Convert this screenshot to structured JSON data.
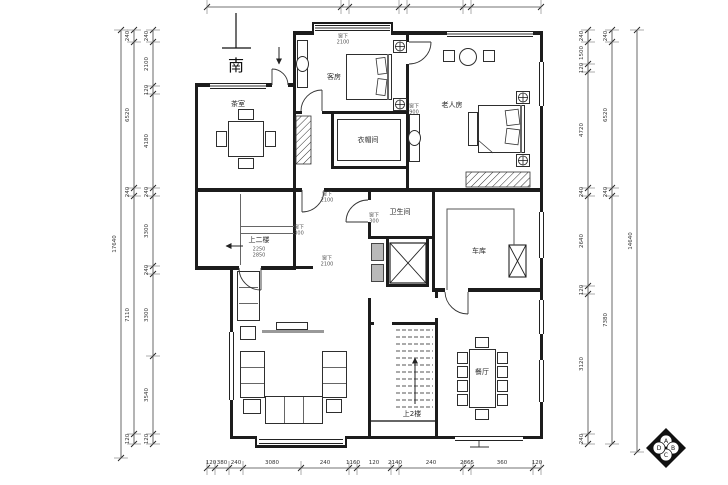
{
  "compass": {
    "label": "南"
  },
  "rooms": [
    {
      "id": "tea-room",
      "label": "茶室",
      "x": 238,
      "y": 104
    },
    {
      "id": "guest-room",
      "label": "客房",
      "x": 334,
      "y": 77
    },
    {
      "id": "elder-room",
      "label": "老人房",
      "x": 452,
      "y": 105
    },
    {
      "id": "cloak-room",
      "label": "衣帽间",
      "x": 368,
      "y": 140
    },
    {
      "id": "bath-room",
      "label": "卫生间",
      "x": 400,
      "y": 212
    },
    {
      "id": "garage",
      "label": "车库",
      "x": 479,
      "y": 251
    },
    {
      "id": "dining-room",
      "label": "餐厅",
      "x": 482,
      "y": 372
    },
    {
      "id": "stair-up",
      "label": "上2楼",
      "x": 412,
      "y": 414
    },
    {
      "id": "hall-up",
      "label": "上二楼",
      "x": 259,
      "y": 240
    }
  ],
  "annotations": [
    {
      "id": "win-top-guest",
      "line1": "窗下",
      "line2": "2100",
      "x": 343,
      "y": 40
    },
    {
      "id": "win-corr-1",
      "line1": "窗下",
      "line2": "2100",
      "x": 327,
      "y": 198
    },
    {
      "id": "win-corr-2",
      "line1": "窗下",
      "line2": "2100",
      "x": 327,
      "y": 262
    },
    {
      "id": "win-hall",
      "line1": "窗下",
      "line2": "300",
      "x": 299,
      "y": 231
    },
    {
      "id": "win-duct",
      "line1": "窗下",
      "line2": "300",
      "x": 374,
      "y": 219
    },
    {
      "id": "win-elder",
      "line1": "窗下",
      "line2": "900",
      "x": 414,
      "y": 110
    },
    {
      "id": "hall-steps-num",
      "line1": "2250",
      "line2": "2850",
      "x": 259,
      "y": 253
    }
  ],
  "dimensions": {
    "chains": [
      {
        "id": "left-total",
        "orient": "v",
        "pos": 121,
        "marks": [
          30,
          458
        ],
        "values": [
          "17640"
        ]
      },
      {
        "id": "left-outer",
        "orient": "v",
        "pos": 134,
        "marks": [
          30,
          42,
          188,
          196,
          434,
          444
        ],
        "values": [
          "240",
          "6520",
          "240",
          "7110",
          "120"
        ]
      },
      {
        "id": "left-inner",
        "orient": "v",
        "pos": 153,
        "marks": [
          30,
          42,
          86,
          94,
          188,
          196,
          266,
          274,
          356,
          434,
          444
        ],
        "values": [
          "240",
          "2100",
          "120",
          "4180",
          "240",
          "3300",
          "240",
          "3300",
          "3540",
          "120"
        ]
      },
      {
        "id": "right-inner",
        "orient": "v",
        "pos": 588,
        "marks": [
          30,
          42,
          64,
          72,
          188,
          196,
          286,
          294,
          434,
          444
        ],
        "values": [
          "240",
          "1500",
          "120",
          "4720",
          "240",
          "2640",
          "120",
          "3120",
          "240"
        ]
      },
      {
        "id": "right-outer",
        "orient": "v",
        "pos": 612,
        "marks": [
          30,
          42,
          188,
          196,
          444
        ],
        "values": [
          "240",
          "6520",
          "240",
          "7380"
        ]
      },
      {
        "id": "right-total",
        "orient": "v",
        "pos": 637,
        "marks": [
          30,
          452
        ],
        "values": [
          "14640"
        ]
      },
      {
        "id": "bottom",
        "orient": "h",
        "pos": 468,
        "marks": [
          207,
          215,
          229,
          243,
          301,
          349,
          357,
          391,
          399,
          463,
          471,
          533,
          541
        ],
        "values": [
          "120",
          "380",
          "240",
          "3080",
          "240",
          "1160",
          "120",
          "2140",
          "240",
          "2865",
          "360",
          "120"
        ]
      },
      {
        "id": "top",
        "orient": "h",
        "pos": 7,
        "marks": [
          207,
          341,
          349,
          399,
          407,
          463,
          471,
          541
        ],
        "values": [
          "",
          "",
          "",
          "",
          "",
          "",
          ""
        ]
      }
    ]
  },
  "logo": {
    "letters": [
      {
        "t": "A",
        "dx": 0,
        "dy": -7
      },
      {
        "t": "B",
        "dx": 7,
        "dy": 0
      },
      {
        "t": "C",
        "dx": 0,
        "dy": 7
      },
      {
        "t": "D",
        "dx": -7,
        "dy": 0
      }
    ]
  }
}
